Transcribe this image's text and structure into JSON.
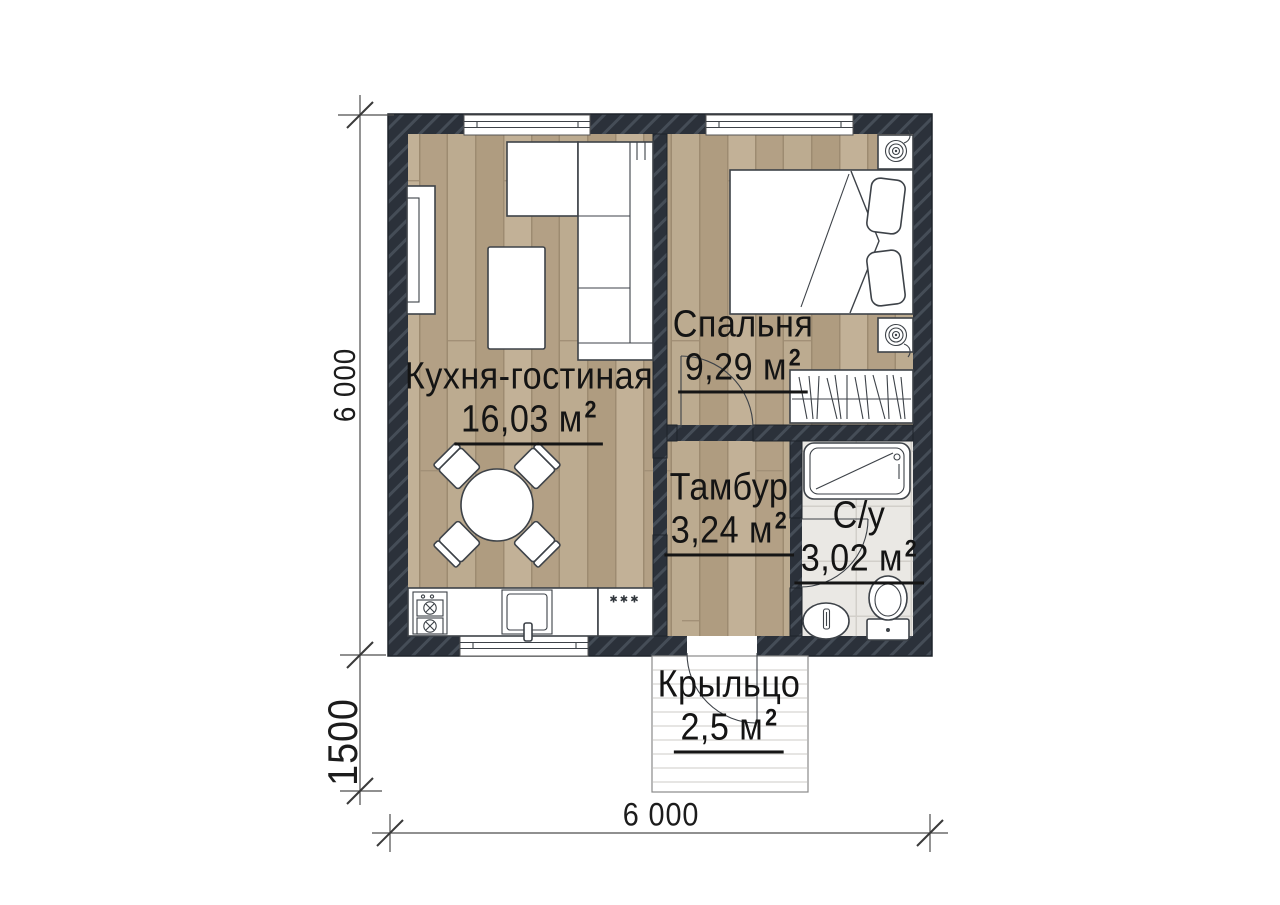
{
  "plan": {
    "rooms": [
      {
        "id": "kitchen-living",
        "name": "Кухня-гостиная",
        "area": "16,03 м",
        "sup": "2"
      },
      {
        "id": "bedroom",
        "name": "Спальня",
        "area": "9,29 м",
        "sup": "2"
      },
      {
        "id": "vestibule",
        "name": "Тамбур",
        "area": "3,24 м",
        "sup": "2"
      },
      {
        "id": "bathroom",
        "name": "С/у",
        "area": "3,02 м",
        "sup": "2"
      },
      {
        "id": "porch",
        "name": "Крыльцо",
        "area": "2,5 м",
        "sup": "2"
      }
    ],
    "dimensions": {
      "left_total": "6 000",
      "left_porch": "1500",
      "bottom_total": "6 000"
    },
    "fridge_mark": "✱✱✱",
    "colors": {
      "wall": "#2b313a",
      "wall_hatch": "#454d57",
      "floor_wood": "#b7a489",
      "bathroom_tile": "#eae8e4",
      "furniture_outline": "#3d4248",
      "text": "#141414"
    }
  }
}
